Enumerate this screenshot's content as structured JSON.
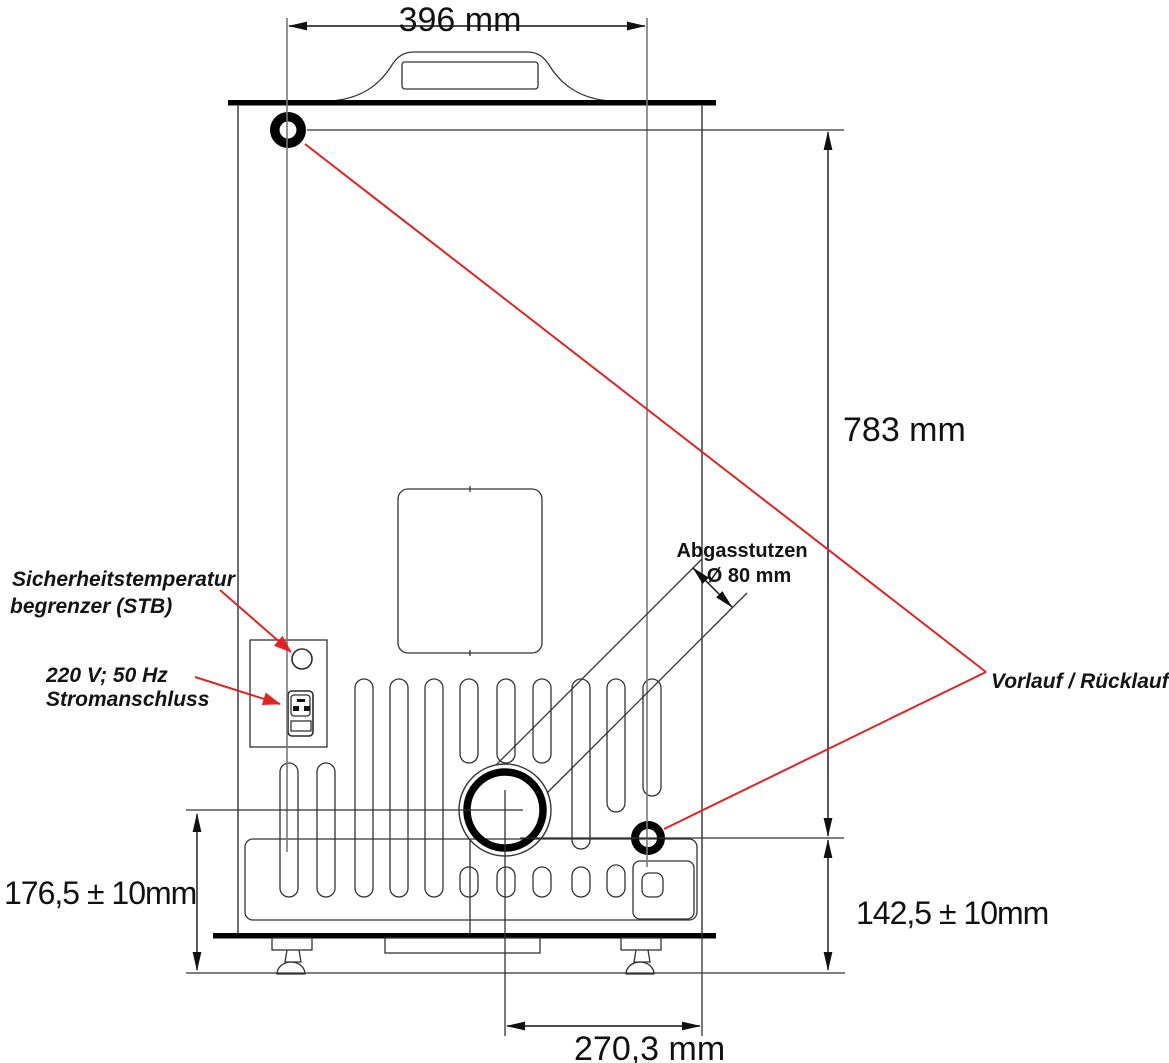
{
  "diagram": {
    "title": "appliance-rear-view-dimension-drawing",
    "dimensions": {
      "top_width": "396 mm",
      "overall_height": "783 mm",
      "exhaust_center_height": "176,5 ± 10mm",
      "connection_center_height": "142,5 ± 10mm",
      "exhaust_horizontal_offset": "270,3 mm",
      "exhaust_diameter": "Ø 80 mm"
    },
    "labels": {
      "stb_line1": "Sicherheitstemperatur",
      "stb_line2": "begrenzer (STB)",
      "power_line1": "220 V; 50 Hz",
      "power_line2": "Stromanschluss",
      "exhaust_name": "Abgasstutzen",
      "flow_return": "Vorlauf / Rücklauf"
    },
    "colors": {
      "leader_red": "#e02424",
      "line_dark": "#111111",
      "line_gray": "#6e6e6e"
    }
  }
}
